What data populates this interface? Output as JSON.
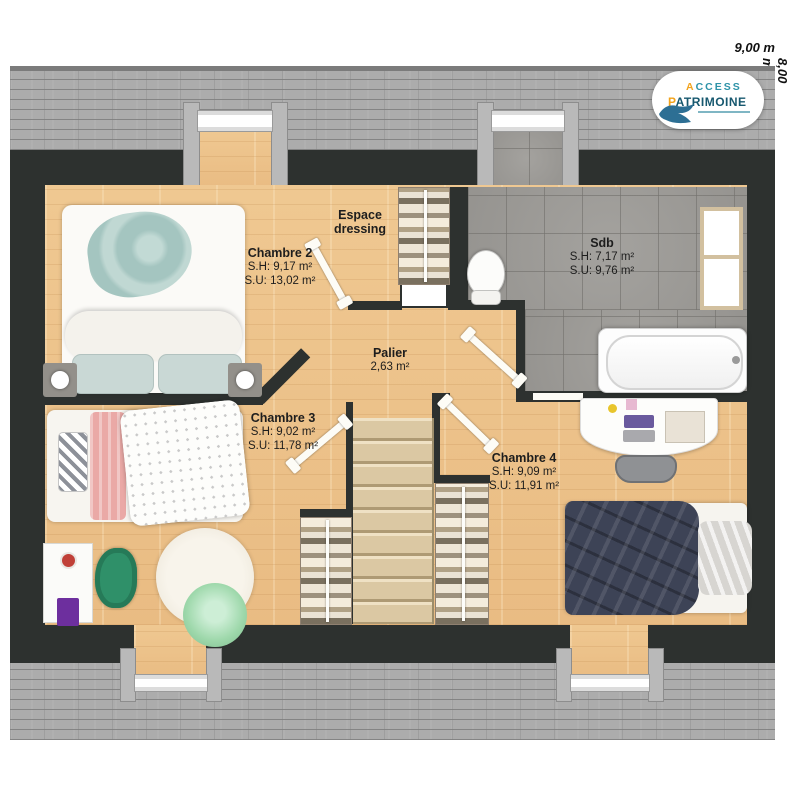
{
  "dimensions": {
    "width": "9,00 m",
    "height": "8,00 m"
  },
  "logo": {
    "accent1": "A",
    "rest1": "CCESS",
    "accent2": "P",
    "rest2": "ATRIMOINE"
  },
  "rooms": {
    "chambre2": {
      "name": "Chambre 2",
      "sh": "S.H: 9,17 m²",
      "su": "S.U: 13,02 m²"
    },
    "dressing": {
      "line1": "Espace",
      "line2": "dressing"
    },
    "sdb": {
      "name": "Sdb",
      "sh": "S.H: 7,17 m²",
      "su": "S.U: 9,76 m²"
    },
    "palier": {
      "name": "Palier",
      "area": "2,63 m²"
    },
    "chambre3": {
      "name": "Chambre 3",
      "sh": "S.H: 9,02 m²",
      "su": "S.U: 11,78 m²"
    },
    "chambre4": {
      "name": "Chambre 4",
      "sh": "S.H: 9,09 m²",
      "su": "S.U: 11,91 m²"
    }
  },
  "colors": {
    "wall": "#2d312f",
    "wood": "#ecc28b",
    "tile": "#9d9b97",
    "roof": "#acacac",
    "accent_orange": "#f2a31c",
    "accent_teal": "#2e93a8",
    "logo_dark": "#17586f"
  }
}
